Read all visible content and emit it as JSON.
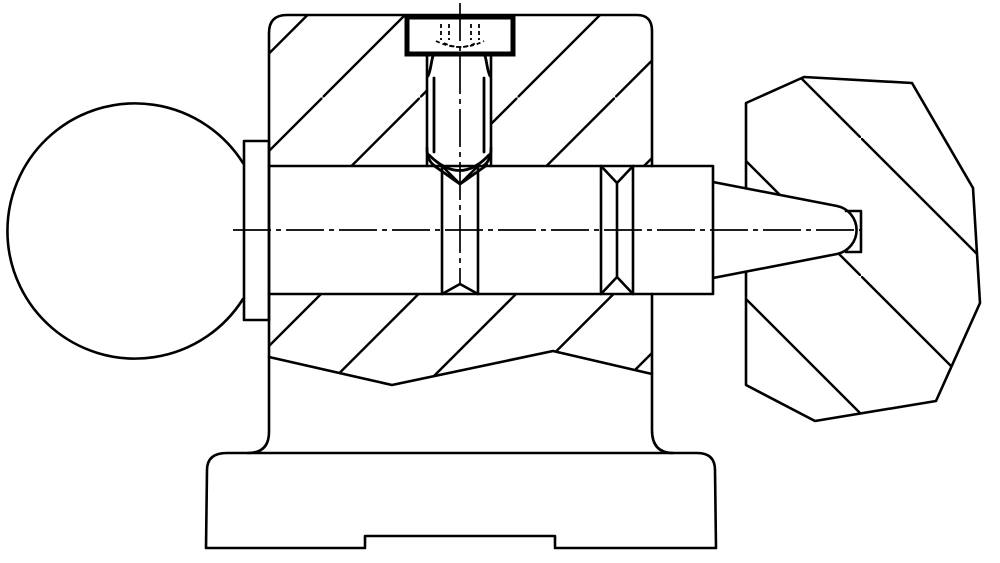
{
  "figure": {
    "type": "engineering-cross-section-drawing",
    "description": "Sectional technical drawing of a clamping handle assembly: ball knob with collar at left, section-hatched housing with a vertical hex set screw locking a horizontal shaft, shaft with two chamfered cross holes, tapered shaft end pressed into a faceted polygonal knob at right, mounted on a stepped machine base",
    "background_color": "#ffffff",
    "line_color": "#000000"
  },
  "parts": [
    {
      "name": "ball-handle",
      "description": "spherical knob on left end"
    },
    {
      "name": "collar",
      "description": "cylindrical flange between ball and housing"
    },
    {
      "name": "housing",
      "description": "sectioned bracket body with diagonal hatching and internal cavity"
    },
    {
      "name": "set-screw",
      "description": "vertical hex-head screw with cone point seated in shaft dimple"
    },
    {
      "name": "shaft",
      "description": "horizontal spindle with two chamfered cross-drilled holes and tapered right end"
    },
    {
      "name": "knob",
      "description": "faceted polygonal hand knob press-fitted on shaft taper, opposite hatch direction"
    },
    {
      "name": "base",
      "description": "stepped foot with relieved bottom notch"
    }
  ],
  "hatching": {
    "housing_direction": "bottom-left to top-right 45deg",
    "housing_spacing_px": 97.5,
    "knob_direction": "top-left to bottom-right 45deg",
    "knob_spacing_px": 138
  }
}
